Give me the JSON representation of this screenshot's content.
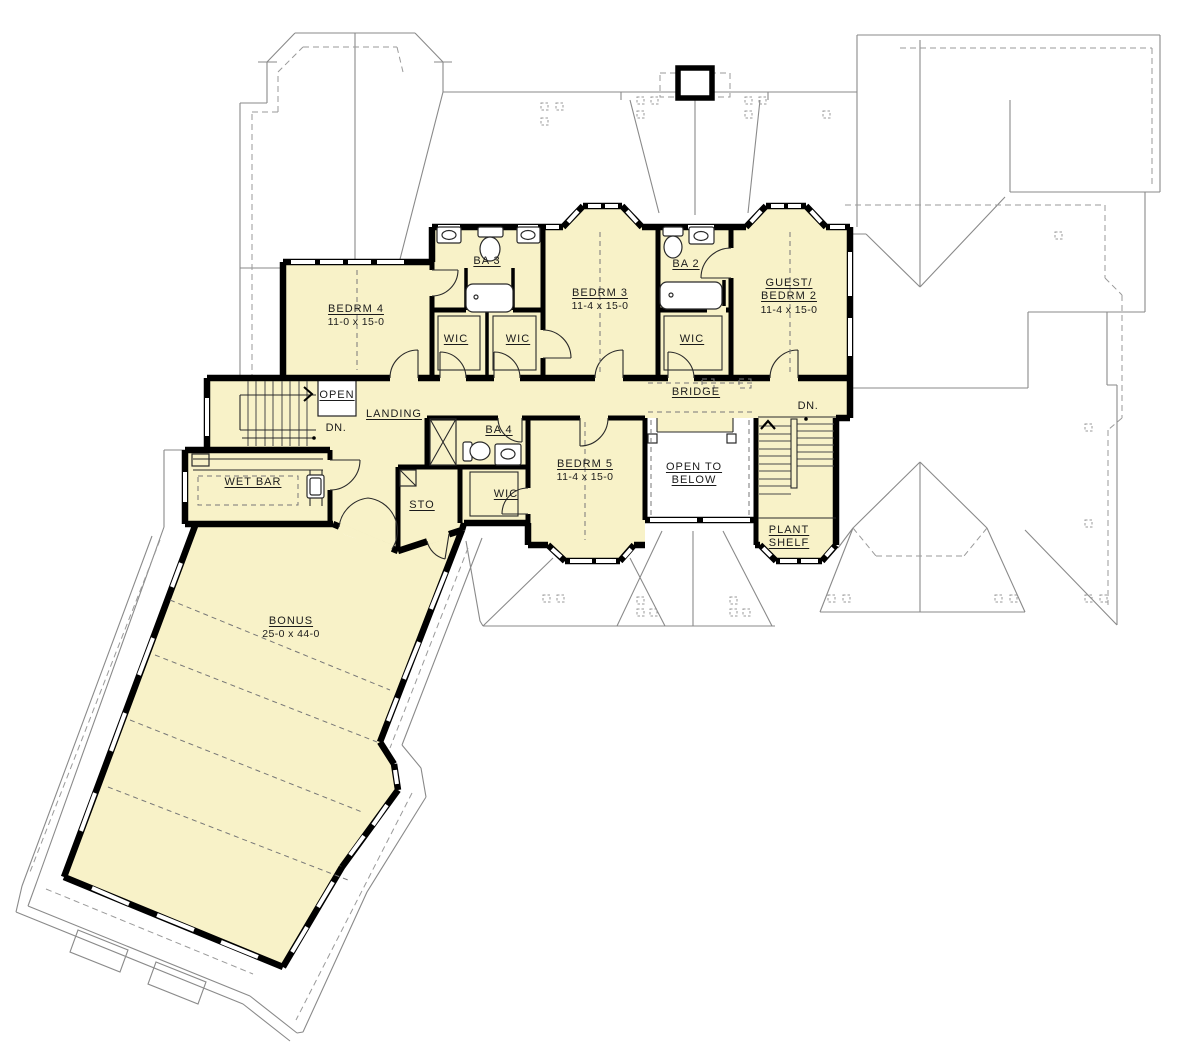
{
  "plan": {
    "type": "second floor plan",
    "colors": {
      "room_fill": "#F8F2C8",
      "open_fill": "#FFFFFF",
      "wall": "#000000",
      "roof_line": "#8A8A8A"
    }
  },
  "labels": {
    "bedrm4": {
      "name": "BEDRM 4",
      "dims": "11-0 x 15-0"
    },
    "ba3": {
      "name": "BA 3"
    },
    "wic_a": {
      "name": "WIC"
    },
    "wic_b": {
      "name": "WIC"
    },
    "bedrm3": {
      "name": "BEDRM 3",
      "dims": "11-4 x 15-0"
    },
    "ba2": {
      "name": "BA 2"
    },
    "wic_c": {
      "name": "WIC"
    },
    "guest_bedrm2": {
      "line1": "GUEST/",
      "line2": "BEDRM 2",
      "dims": "11-4 x 15-0"
    },
    "open": {
      "name": "OPEN"
    },
    "landing": {
      "name": "LANDING"
    },
    "dn_left": {
      "name": "DN."
    },
    "bridge": {
      "name": "BRIDGE"
    },
    "dn_right": {
      "name": "DN."
    },
    "wet_bar": {
      "name": "WET BAR"
    },
    "ba4": {
      "name": "BA 4"
    },
    "sto": {
      "name": "STO"
    },
    "wic_d": {
      "name": "WIC"
    },
    "bedrm5": {
      "name": "BEDRM 5",
      "dims": "11-4 x 15-0"
    },
    "open_to_below": {
      "line1": "OPEN TO",
      "line2": "BELOW"
    },
    "plant_shelf": {
      "line1": "PLANT",
      "line2": "SHELF"
    },
    "bonus": {
      "name": "BONUS",
      "dims": "25-0 x 44-0"
    }
  }
}
